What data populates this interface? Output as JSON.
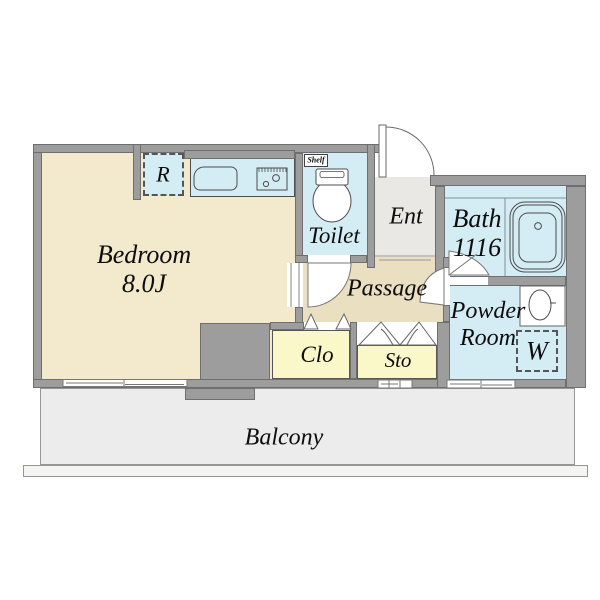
{
  "plan": {
    "rooms": {
      "bedroom": {
        "name": "Bedroom",
        "size": "8.0J"
      },
      "refrigerator": {
        "label": "R"
      },
      "toilet": {
        "name": "Toilet",
        "shelf": "Shelf"
      },
      "entrance": {
        "name": "Ent"
      },
      "bath": {
        "name": "Bath",
        "size": "1116"
      },
      "passage": {
        "name": "Passage"
      },
      "powder_room": {
        "line1": "Powder",
        "line2": "Room",
        "washer": "W"
      },
      "closet": {
        "name": "Clo"
      },
      "storage": {
        "name": "Sto"
      },
      "balcony": {
        "name": "Balcony"
      }
    },
    "colors": {
      "room_beige": "#f3e9cd",
      "passage_tan": "#ebdfc1",
      "wet_area_blue": "#d4ecf4",
      "closet_yellow": "#faf7c9",
      "entrance_gray": "#e9e8e5",
      "balcony_gray": "#ececec",
      "wall_gray": "#9d9d9d",
      "wall_outline": "#6f6f6f",
      "text": "#0d0d0d"
    }
  }
}
